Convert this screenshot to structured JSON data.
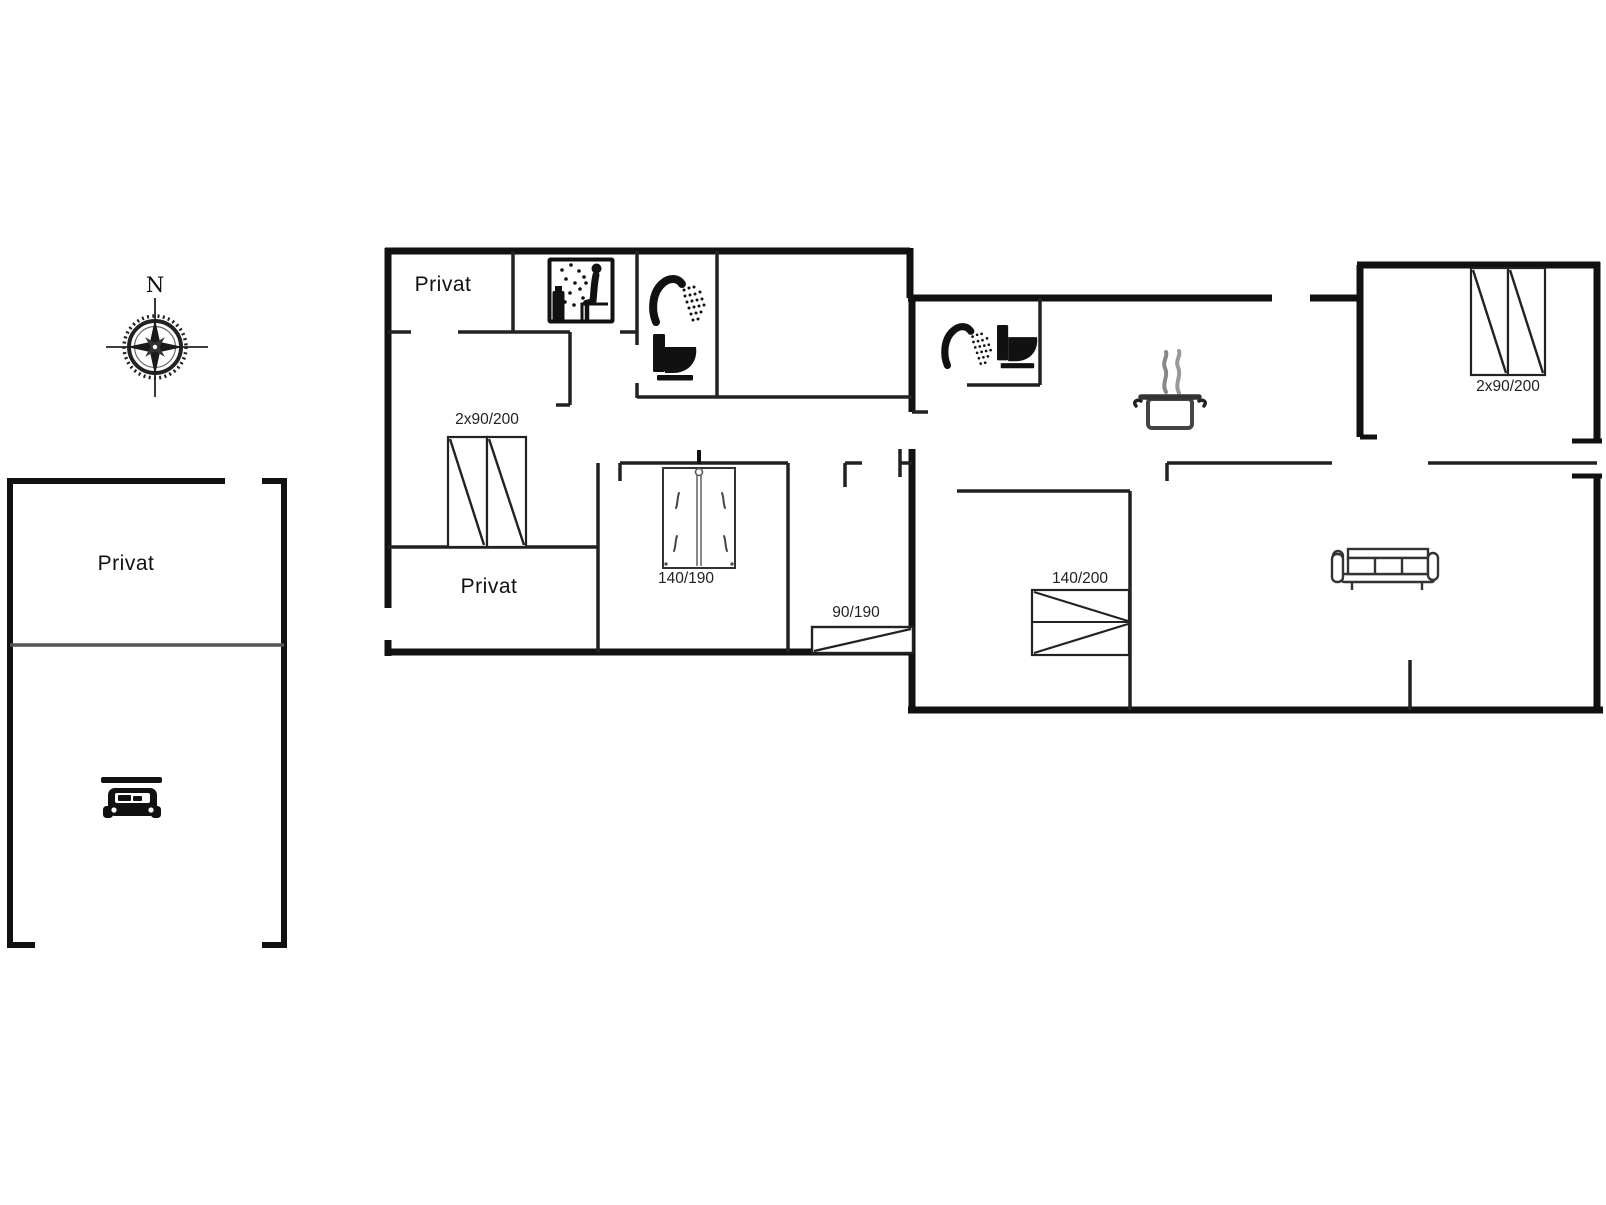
{
  "page": {
    "type": "floor-plan",
    "background": "#ffffff"
  },
  "colors": {
    "outer_wall": "#111111",
    "interior_wall": "#222222",
    "carport_divider": "#555555",
    "steam_grey": "#888888",
    "furniture_outline": "#333333",
    "label_text": "#111111"
  },
  "compass": {
    "north_label": "N"
  },
  "carport": {
    "room_label": "Privat"
  },
  "house": {
    "rooms": {
      "top_left_label": "Privat",
      "bottom_left_label": "Privat"
    },
    "beds": {
      "left_double": "2x90/200",
      "double_140_190": "140/190",
      "single_90_190": "90/190",
      "double_140_200": "140/200",
      "right_double": "2x90/200"
    }
  },
  "icons": [
    "compass-rose-icon",
    "car-icon",
    "sauna-icon",
    "shower-icon",
    "toilet-icon",
    "cooking-pot-icon",
    "sofa-icon"
  ]
}
